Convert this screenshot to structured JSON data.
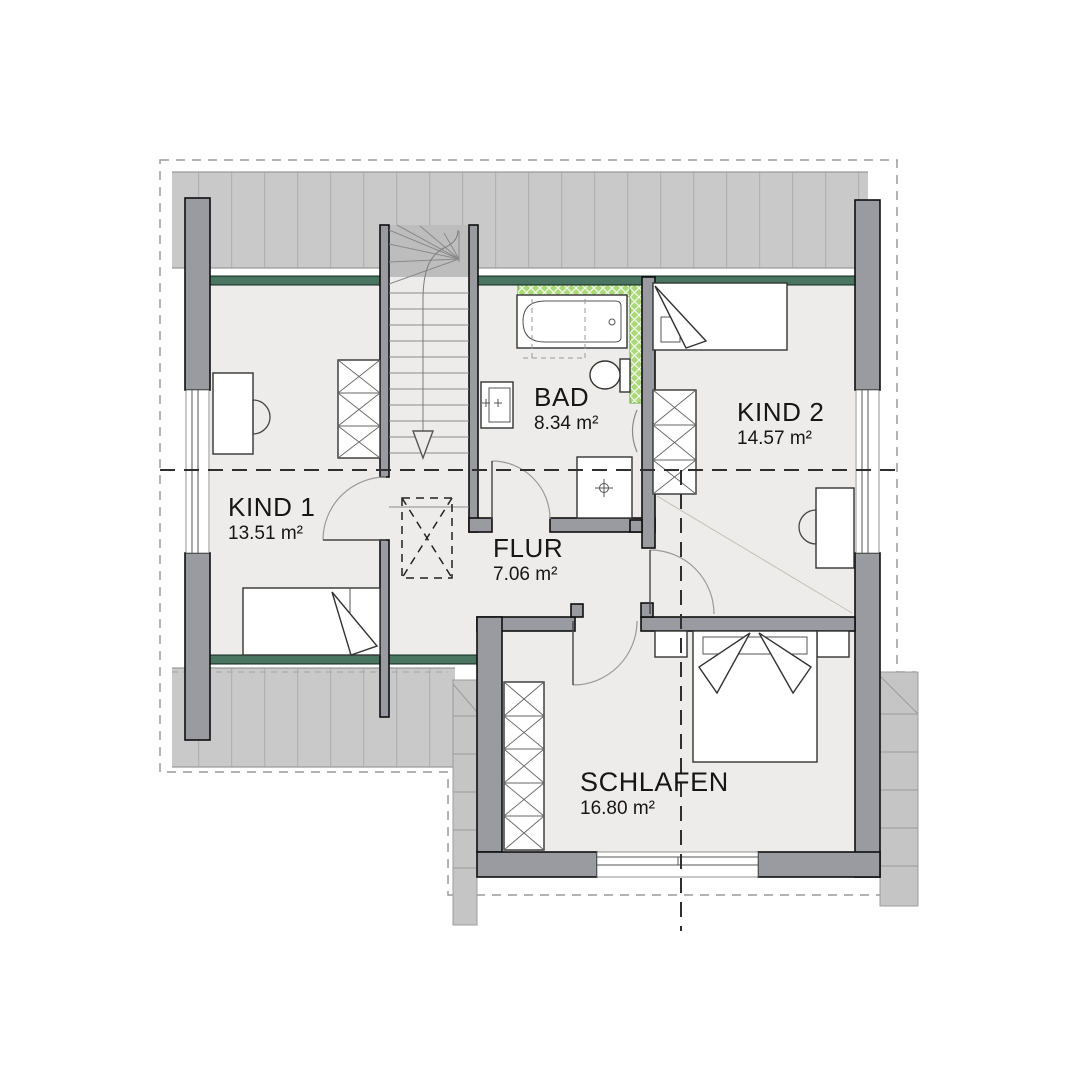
{
  "plan": {
    "rooms": [
      {
        "name": "KIND 1",
        "area": "13.51 m²"
      },
      {
        "name": "BAD",
        "area": "8.34 m²"
      },
      {
        "name": "KIND 2",
        "area": "14.57 m²"
      },
      {
        "name": "FLUR",
        "area": "7.06 m²"
      },
      {
        "name": "SCHLAFEN",
        "area": "16.80 m²"
      }
    ],
    "fixtures": [
      "stairs-down",
      "bathtub",
      "washbasin",
      "toilet",
      "shower",
      "radiator",
      "wardrobe",
      "single-bed",
      "double-bed",
      "nightstand",
      "desk",
      "chair",
      "window",
      "door-swing",
      "roof-overhang-hatch"
    ],
    "colors": {
      "wall_fill": "#9a9aa1",
      "roof_hatch": "#c9c9c9",
      "stairwell_hatch": "#bdbdbd",
      "accent_wall_green": "#4a7561",
      "bath_tile_green": "#abd879",
      "floor": "#edecea"
    }
  }
}
